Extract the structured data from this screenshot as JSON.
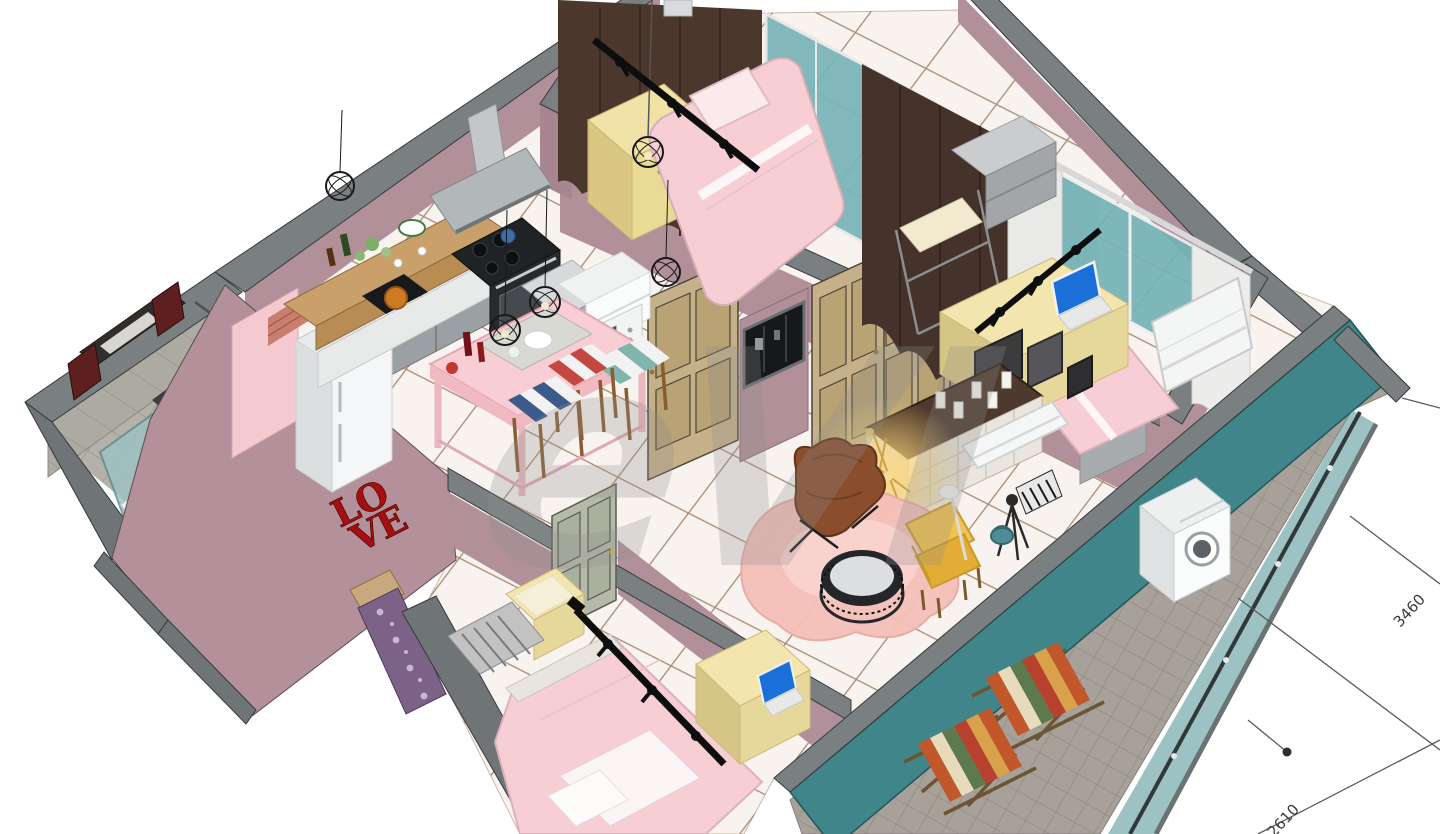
{
  "canvas": {
    "width": 1440,
    "height": 834,
    "background": "#ffffff"
  },
  "watermark": {
    "text": "eVI"
  },
  "dimension_labels": {
    "right": "3460",
    "bottom": "2610"
  },
  "love_sign": {
    "top": "LO",
    "bottom": "VE"
  },
  "palette": {
    "wall_cap_gray": "#7a8081",
    "wall_mauve": "#b2909a",
    "wall_mauve_exterior": "#b4919a",
    "wall_pink": "#f4c9cf",
    "wall_teal": "#3f8589",
    "floor_tile_white": "#f8f3ee",
    "floor_grout": "#a3846d",
    "bathroom_gray_tile": "#b5b1a9",
    "bathroom_beige_tile": "#dbd2c5",
    "balcony_tile": "#a7a19a",
    "bed_pink": "#f6ced4",
    "desk_cream": "#f2e6ae",
    "door_tan": "#c6b089",
    "door_gray_green": "#b6b9a8",
    "curtain_brown": "#4c372d",
    "window_teal": "#79b4b7",
    "armchair_yellow": "#f2c24e",
    "butterfly_chair_brown": "#8a4e2c",
    "rug_pink": "#f4bfb9",
    "love_red": "#a50f0f",
    "deck_stripe_orange": "#c2572c",
    "deck_stripe_green": "#5d7a4e",
    "track_light_black": "#0e0e0e"
  }
}
